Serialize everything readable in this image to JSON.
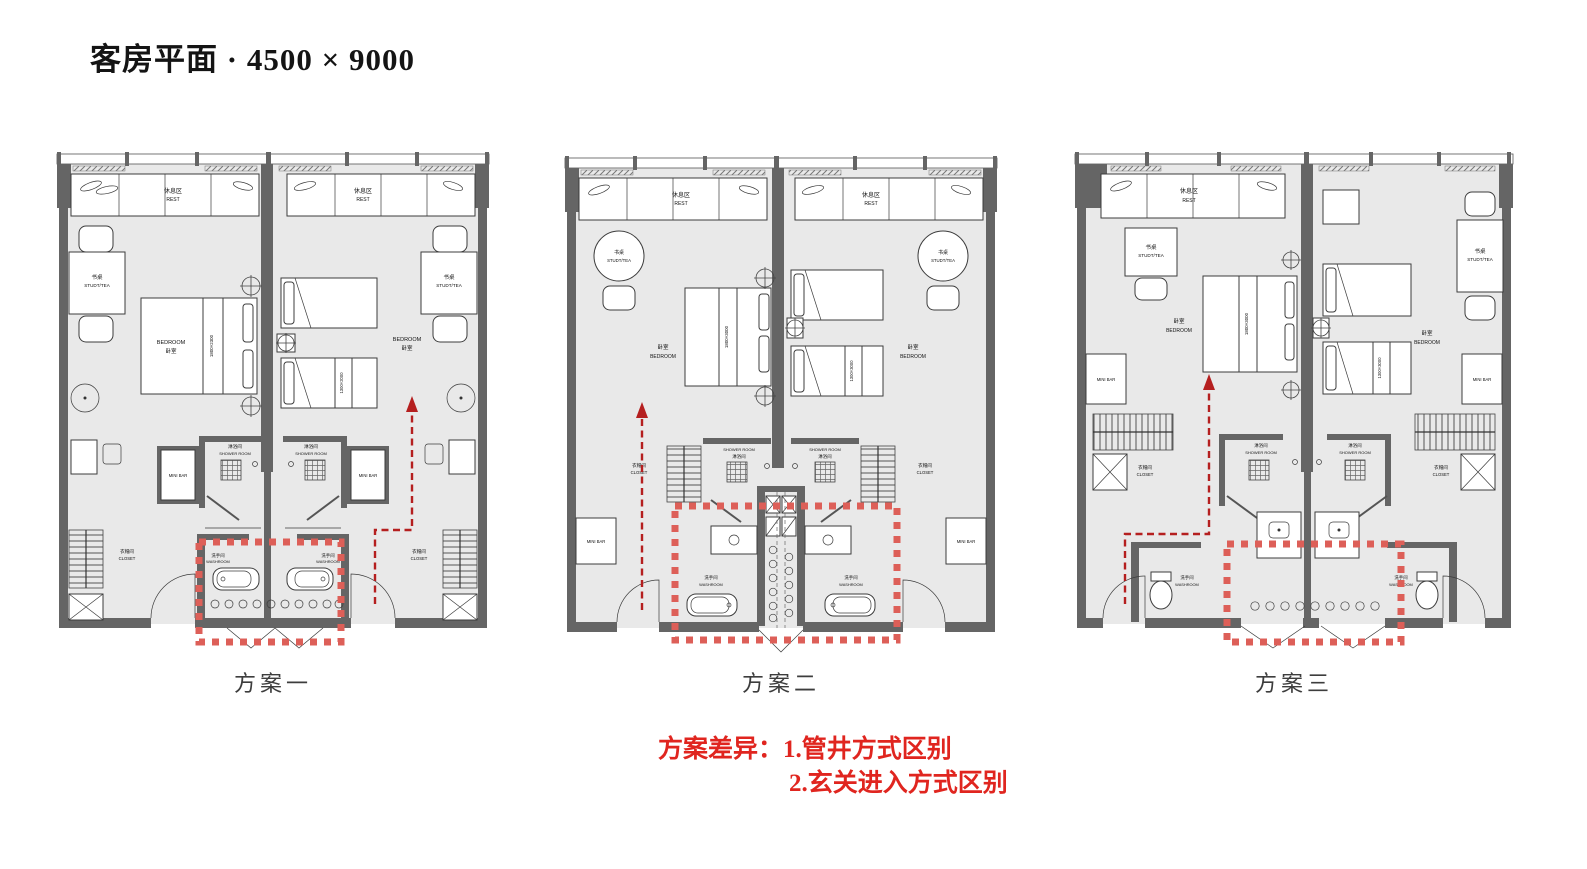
{
  "title": "客房平面 · 4500 × 9000",
  "notes": {
    "prefix": "方案差异：",
    "item1": "1.管井方式区别",
    "item2": "2.玄关进入方式区别"
  },
  "colors": {
    "highlight": "#dd5f58",
    "arrow": "#b51f1f",
    "note": "#e0251f",
    "wall": "#656565",
    "floor": "#e9e9e9"
  },
  "plans": [
    {
      "caption": "方案一",
      "rest_cn": "休息区",
      "rest_en": "REST",
      "desk_cn": "书桌",
      "desk_en": "STUDT/TEA",
      "bed_cn": "卧室",
      "bed_en": "BEDROOM",
      "minibar": "MINI BAR",
      "shower_cn": "淋浴间",
      "shower_en": "SHOWER ROOM",
      "wash_cn": "洗手间",
      "wash_en": "WASHROOM",
      "closet_cn": "衣帽间",
      "closet_en": "CLOSET",
      "king_size": "1800×2300",
      "twin_size": "1300×2000"
    },
    {
      "caption": "方案二",
      "rest_cn": "休息区",
      "rest_en": "REST",
      "desk_cn": "书桌",
      "desk_en": "STUDT/TEA",
      "bed_cn": "卧室",
      "bed_en": "BEDROOM",
      "minibar": "MINI BAR",
      "shower_cn": "淋浴间",
      "shower_en": "SHOWER ROOM",
      "wash_cn": "洗手间",
      "wash_en": "WASHROOM",
      "closet_cn": "衣帽间",
      "closet_en": "CLOSET",
      "king_size": "1800×3000",
      "twin_size": "1300×3000"
    },
    {
      "caption": "方案三",
      "rest_cn": "休息区",
      "rest_en": "REST",
      "desk_cn": "书桌",
      "desk_en": "STUDT/TEA",
      "bed_cn": "卧室",
      "bed_en": "BEDROOM",
      "minibar": "MINI BAR",
      "shower_cn": "淋浴间",
      "shower_en": "SHOWER ROOM",
      "wash_cn": "洗手间",
      "wash_en": "WASHROOM",
      "closet_cn": "衣帽间",
      "closet_en": "CLOSET",
      "king_size": "1800×3000",
      "twin_size": "1300×3000"
    }
  ]
}
